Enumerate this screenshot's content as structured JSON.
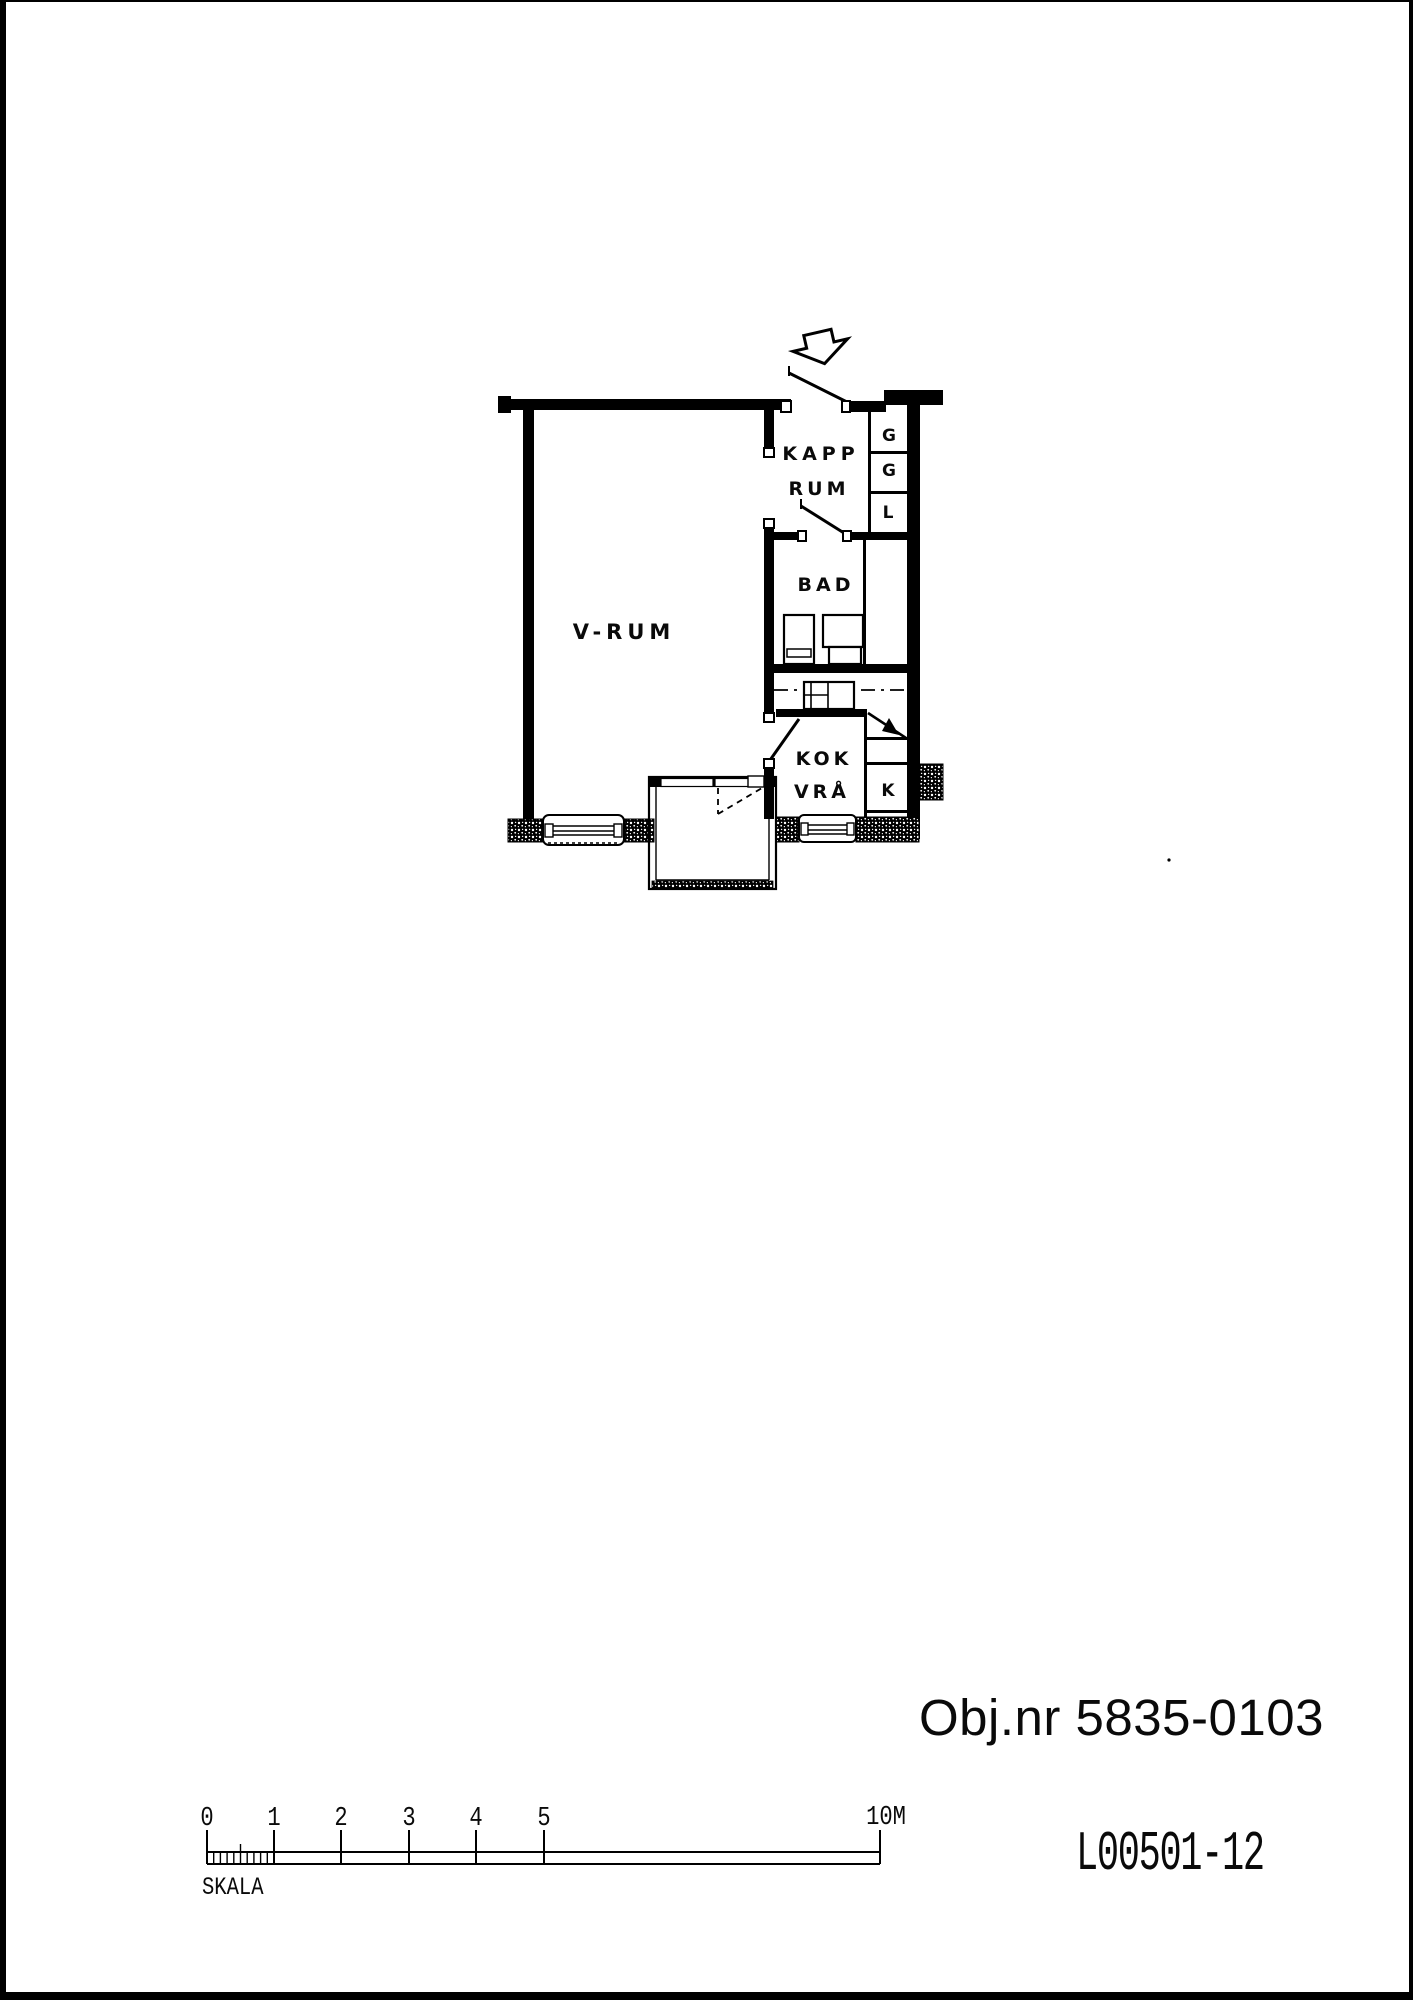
{
  "annotations": {
    "object_number": "Obj.nr 5835-0103",
    "drawing_number": "L00501-12"
  },
  "floorplan": {
    "rooms": {
      "v_rum": "V-RUM",
      "kapp_line1": "KAPP",
      "kapp_line2": "RUM",
      "bad": "BAD",
      "kok_line1": "KOK",
      "kok_line2": "VRÅ",
      "closet_g_upper": "G",
      "closet_g_lower": "G",
      "closet_l": "L",
      "closet_k": "K"
    }
  },
  "scalebar": {
    "title": "SKALA",
    "ticks": [
      "0",
      "1",
      "2",
      "3",
      "4",
      "5"
    ],
    "end": "10M"
  },
  "colors": {
    "ink": "#000000",
    "paper": "#ffffff"
  }
}
